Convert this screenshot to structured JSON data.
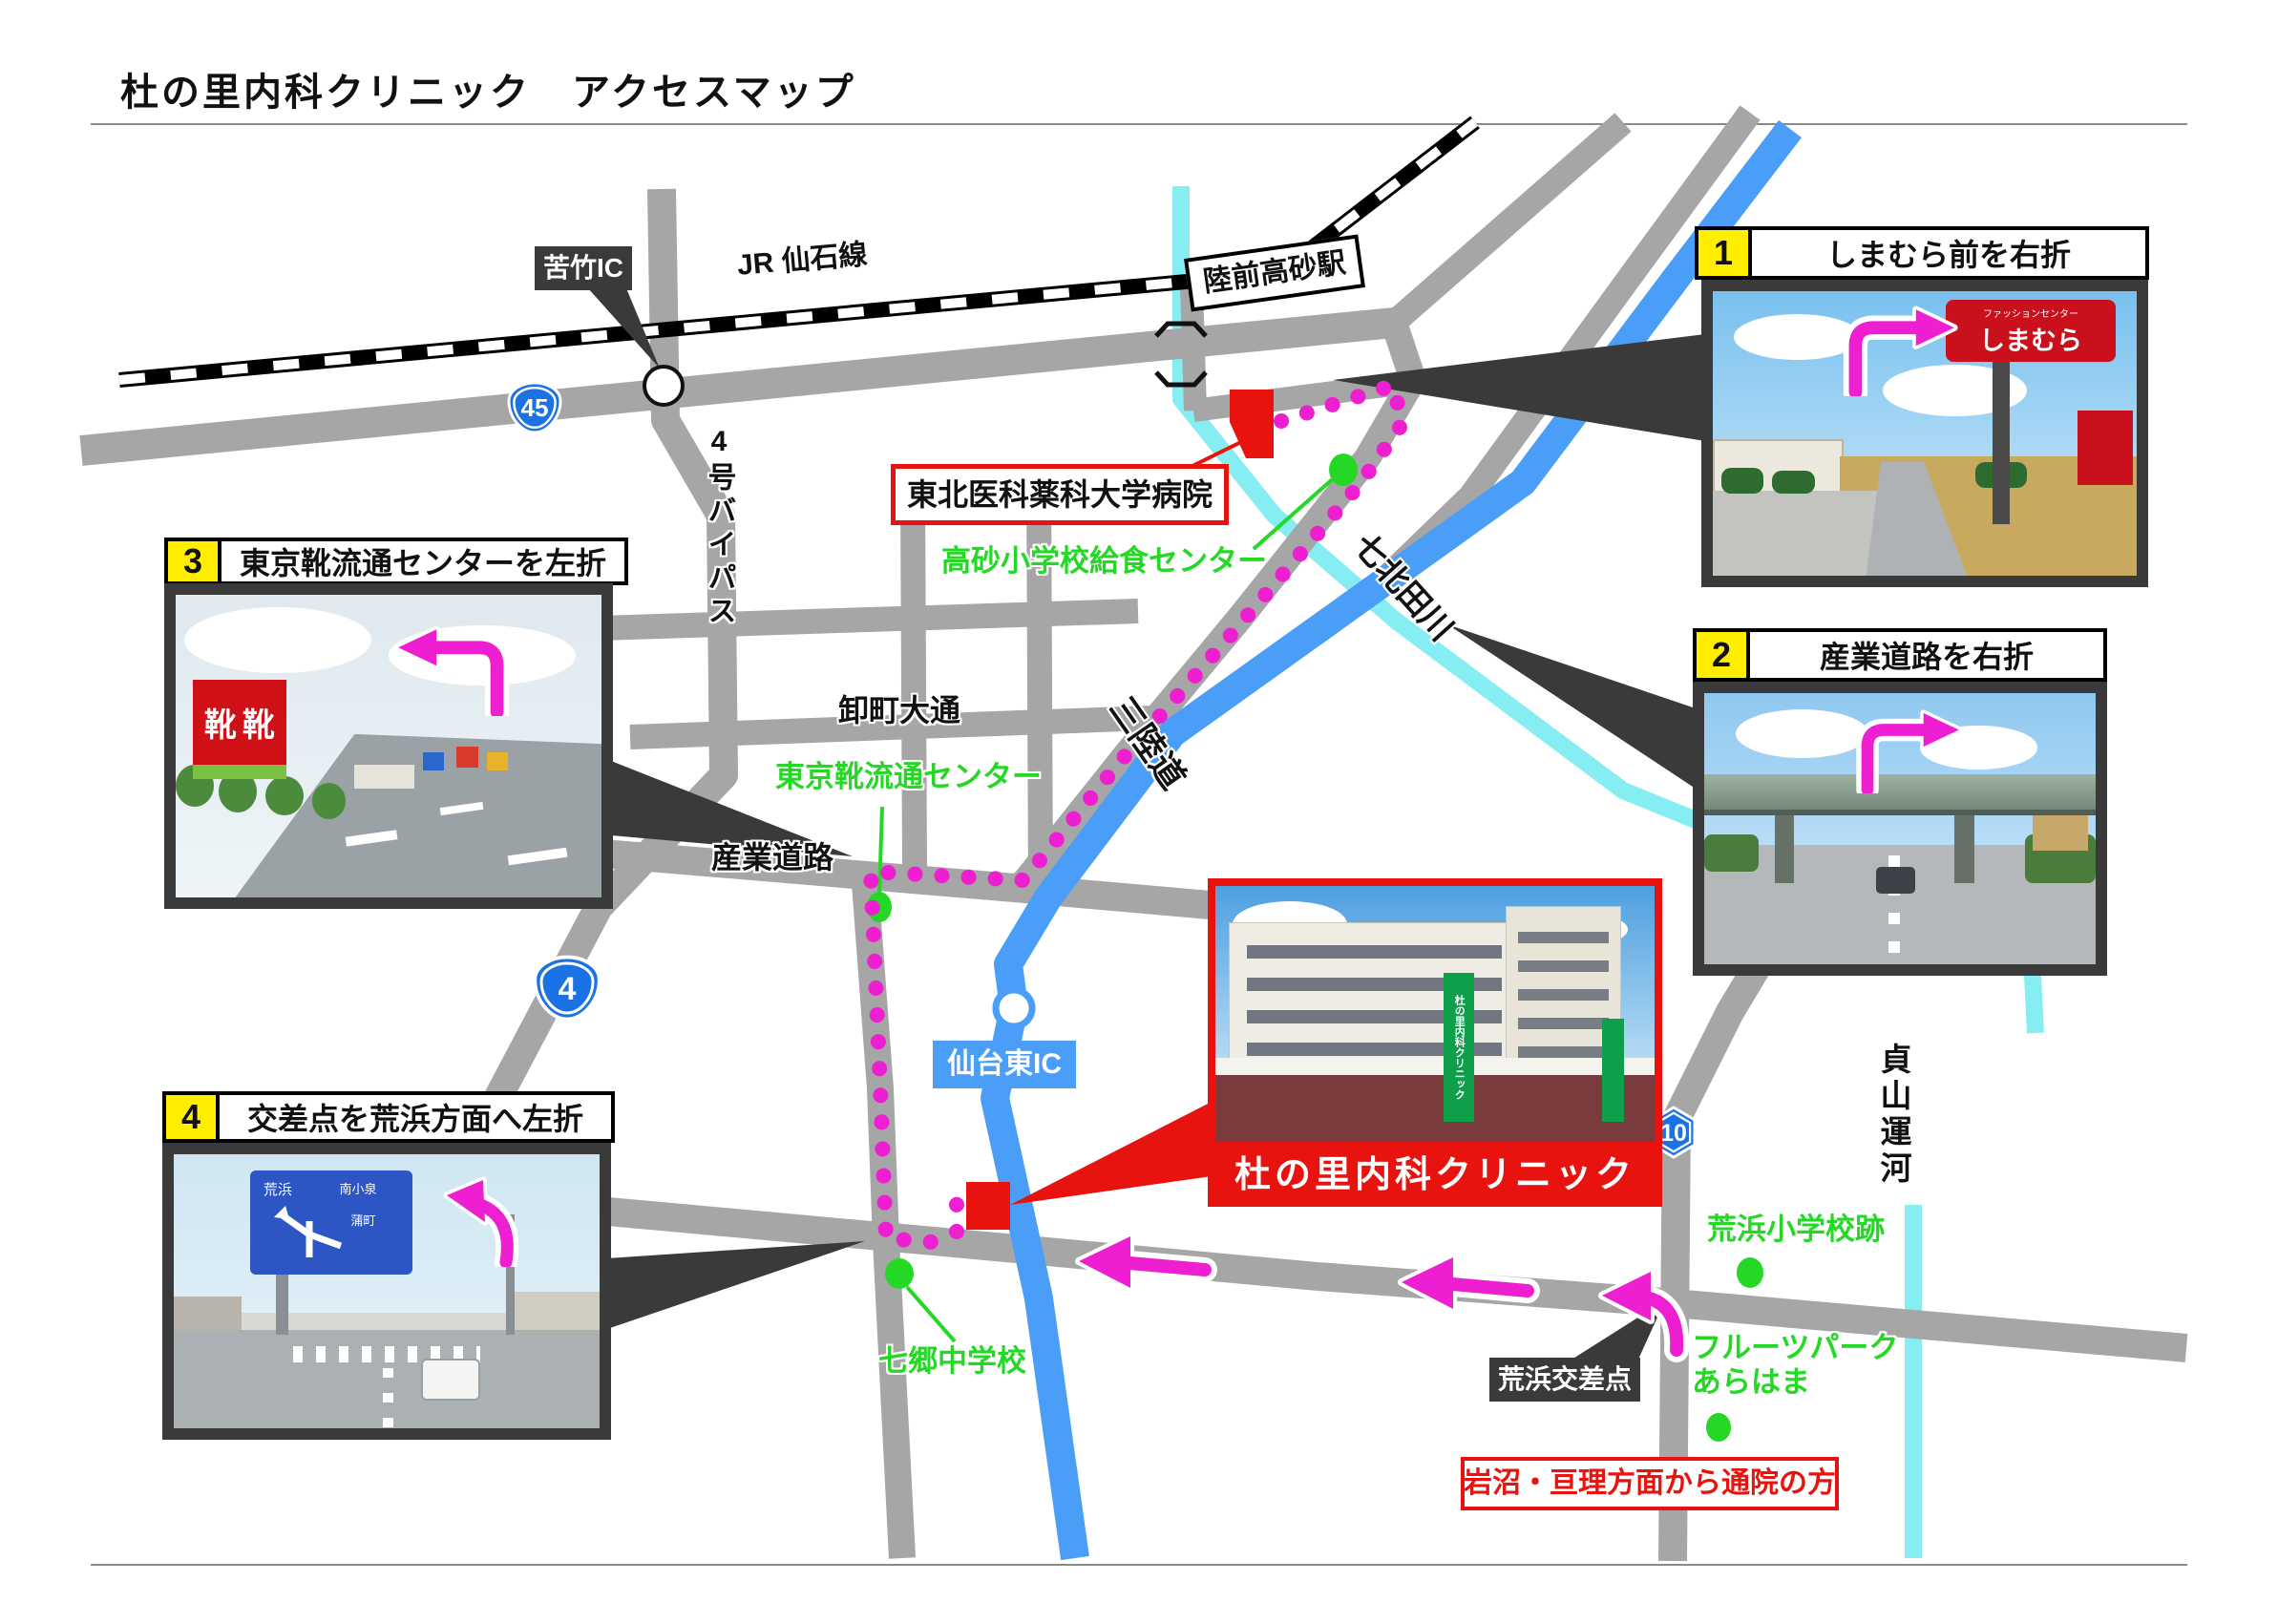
{
  "title": "杜の里内科クリニック　アクセスマップ",
  "map_labels": {
    "kutake_ic": "苦竹IC",
    "jr_line": "JR 仙石線",
    "station": "陸前高砂駅",
    "hospital": "東北医科薬科大学病院",
    "kyushoku_center": "高砂小学校給食センター",
    "nanakita_river": "七北田川",
    "bypass4": "4号バイパス",
    "oroshimachi": "卸町大通",
    "shoe_center": "東京靴流通センター",
    "sangyo_road": "産業道路",
    "sanriku_expwy": "三陸道",
    "sendai_higashi_ic": "仙台東IC",
    "clinic": "杜の里内科クリニック",
    "shichigo_jhs": "七郷中学校",
    "arahama_crossing": "荒浜交差点",
    "arahama_elem": "荒浜小学校跡",
    "fruits_park_line1": "フルーツパーク",
    "fruits_park_line2": "あらはま",
    "iwanuma_note": "岩沼・亘理方面から通院の方",
    "teizan_canal": "貞山運河",
    "route45": "45",
    "route4": "4",
    "route10": "10"
  },
  "instructions": [
    {
      "no": "1",
      "text": "しまむら前を右折"
    },
    {
      "no": "2",
      "text": "産業道路を右折"
    },
    {
      "no": "3",
      "text": "東京靴流通センターを左折"
    },
    {
      "no": "4",
      "text": "交差点を荒浜方面へ左折"
    }
  ],
  "photos": {
    "shimamura_top": "ファッションセンター",
    "shimamura": "しまむら",
    "shoe_char1": "靴",
    "shoe_char2": "靴",
    "p4_sign": [
      "荒浜",
      "南小泉",
      "蒲町"
    ]
  },
  "colors": {
    "magenta": "#ee1fd0",
    "green": "#25d825",
    "red": "#e8120f",
    "road_gray": "#a6a6a6",
    "expressway_blue": "#4b9ef8",
    "water_cyan": "#86eef2",
    "shield_blue": "#1b72e4",
    "dark": "#3a3a3a",
    "yellow": "#ffee00"
  }
}
